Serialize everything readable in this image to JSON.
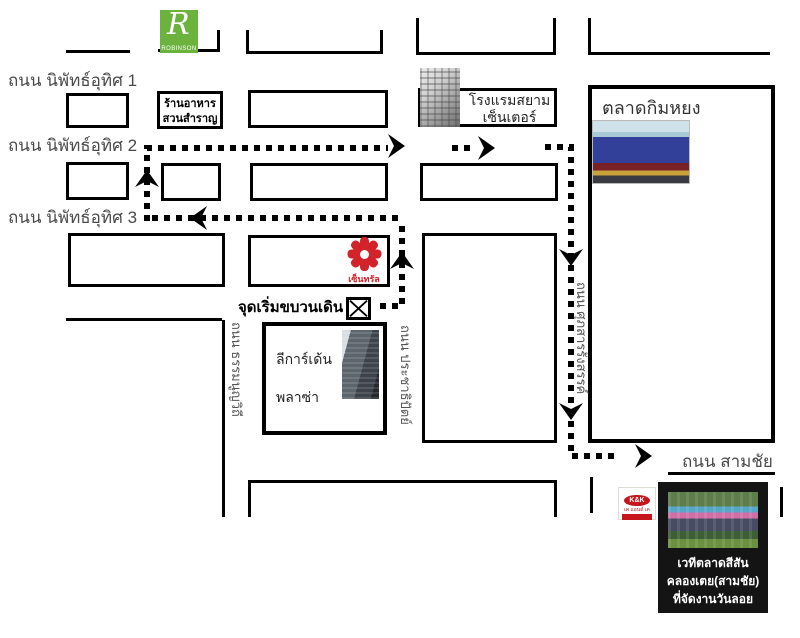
{
  "streets": {
    "niphat1": "ถนน นิพัทธ์อุทิศ 1",
    "niphat2": "ถนน นิพัทธ์อุทิศ 2",
    "niphat3": "ถนน นิพัทธ์อุทิศ 3",
    "samchai": "ถนน สามชัย",
    "thamnoonvithi": "ถนน ธรรมนูญวิถี",
    "prachathipat": "ถนน ประชาธิปัตย์",
    "suphasan": "ถนน ศุภสารรังสรรค์"
  },
  "landmarks": {
    "robinson_letter": "R",
    "robinson_name": "ROBINSON",
    "restaurant": {
      "line1": "ร้านอาหาร",
      "line2": "สวนสำราญ"
    },
    "hotel": {
      "line1": "โรงแรมสยาม",
      "line2": "เซ็นเตอร์"
    },
    "kimyong_market": "ตลาดกิมหยง",
    "central_name": "เซ็นทรัล",
    "parade_start": "จุดเริ่มขบวนเดิน",
    "lee_gardens": {
      "line1": "ลีการ์เด้น",
      "line2": "พลาซ่า"
    },
    "kk": {
      "line1": "K&K",
      "line2": "เค แอนด์ เค"
    },
    "stage": {
      "line1": "เวทีตลาดสีสัน",
      "line2": "คลองเตย(สามชัย)",
      "line3": "ที่จัดงานวันลอยกระทง"
    }
  },
  "colors": {
    "robinson_green": "#6CB33E",
    "central_red": "#D2232A",
    "kk_red": "#C4161C",
    "route_black": "#000000",
    "street_label_gray": "#4A4A4A"
  }
}
